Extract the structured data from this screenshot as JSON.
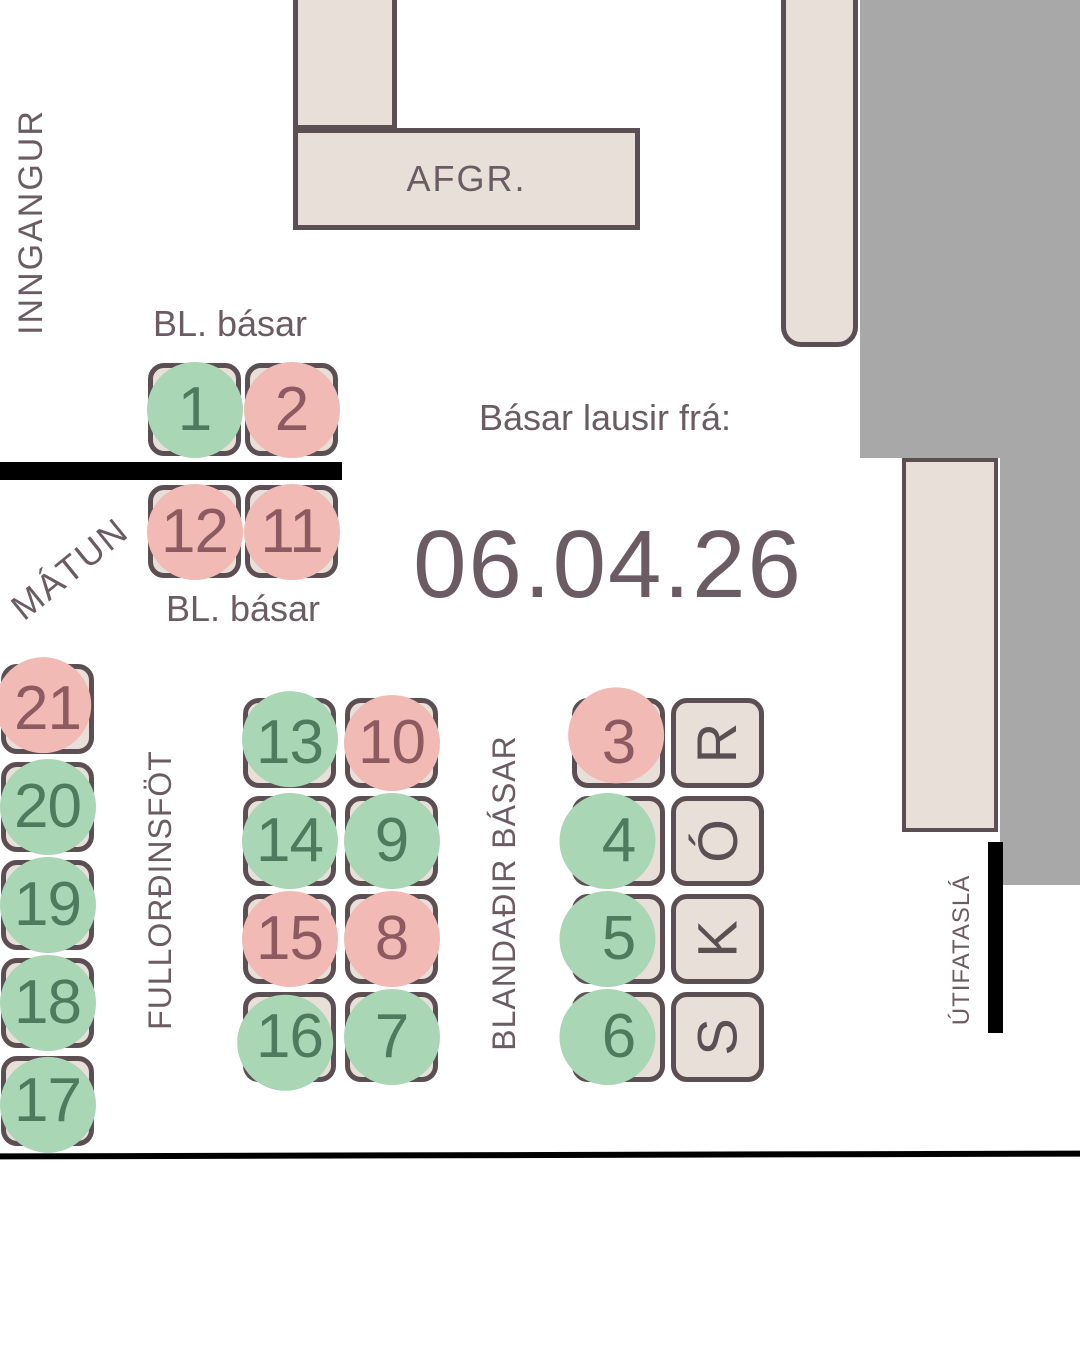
{
  "palette": {
    "background": "#ffffff",
    "wall": "#a9a8a8",
    "boothFill": "#e8e0d8",
    "boothBorder": "#5b4f54",
    "green": "#a9d6b4",
    "pink": "#f1bab4",
    "greenNum": "#4e7a5e",
    "pinkNum": "#8d5a62",
    "label": "#6b5c63",
    "black": "#000000"
  },
  "header": {
    "entrance_label": "INNGANGUR",
    "counter_label": "AFGR."
  },
  "notice": {
    "line1": "Básar lausir frá:",
    "date": "06.04.26"
  },
  "sections": {
    "bl_top_label": "BL. básar",
    "bl_bottom_label": "BL. básar",
    "matun_label": "MÁTUN",
    "adult_clothing_label": "FULLORÐINSFÖT",
    "mixed_label": "BLANDAÐIR BÁSAR",
    "shoes_word": "SKÓR",
    "outerwear_label": "ÚTIFATASLÁ"
  },
  "booths": {
    "bl_top": [
      {
        "id": "1",
        "status": "green"
      },
      {
        "id": "2",
        "status": "pink"
      }
    ],
    "bl_bottom": [
      {
        "id": "12",
        "status": "pink"
      },
      {
        "id": "11",
        "status": "pink"
      }
    ],
    "left_column": [
      {
        "id": "21",
        "status": "pink"
      },
      {
        "id": "20",
        "status": "green"
      },
      {
        "id": "19",
        "status": "green"
      },
      {
        "id": "18",
        "status": "green"
      },
      {
        "id": "17",
        "status": "green"
      }
    ],
    "middle_grid": [
      {
        "id": "13",
        "status": "green"
      },
      {
        "id": "10",
        "status": "pink"
      },
      {
        "id": "14",
        "status": "green"
      },
      {
        "id": "9",
        "status": "green"
      },
      {
        "id": "15",
        "status": "pink"
      },
      {
        "id": "8",
        "status": "pink"
      },
      {
        "id": "16",
        "status": "green"
      },
      {
        "id": "7",
        "status": "green"
      }
    ],
    "right_column": [
      {
        "id": "3",
        "status": "pink"
      },
      {
        "id": "4",
        "status": "green"
      },
      {
        "id": "5",
        "status": "green"
      },
      {
        "id": "6",
        "status": "green"
      }
    ],
    "shoes_letters_top_to_bottom": [
      "R",
      "Ó",
      "K",
      "S"
    ]
  }
}
